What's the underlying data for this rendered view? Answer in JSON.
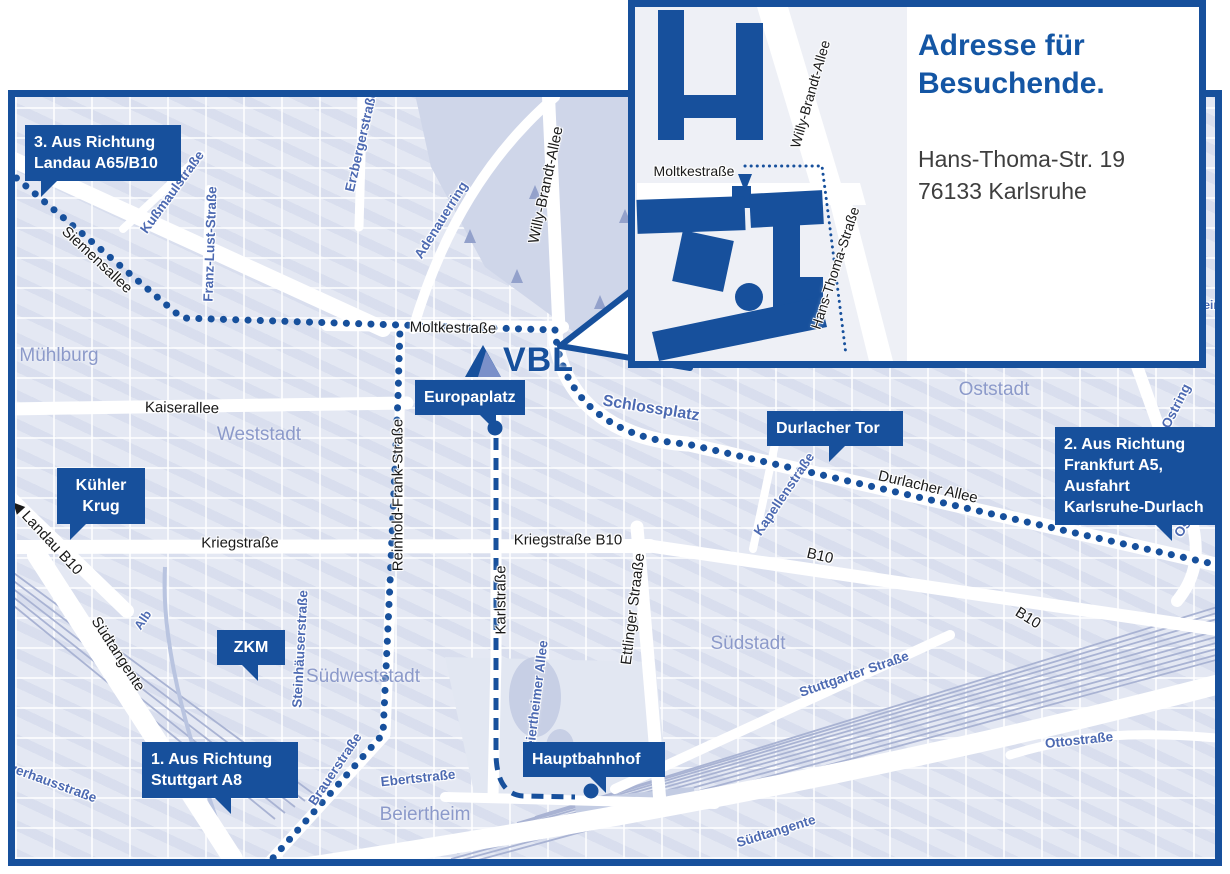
{
  "colors": {
    "brand_blue": "#17509c",
    "title_blue": "#1456a4",
    "map_background": "#e4e8f3",
    "street_label_black": "#1a1a1a",
    "street_label_blue": "#4d6ab2",
    "district_label": "#8c9aca",
    "address_text": "#3e3e3e",
    "park": "#cfd6e9",
    "railway_line": "#a9b3d3"
  },
  "vbl_logo": {
    "text": "VBL"
  },
  "inset": {
    "title_lines": [
      "Adresse für",
      "Besuchende."
    ],
    "address_lines": [
      "Hans-Thoma-Str. 19",
      "76133 Karlsruhe"
    ],
    "labels": [
      {
        "text": "Moltkestraße",
        "x": 59,
        "y": 164,
        "rot": 0,
        "size": 14,
        "color": "black"
      },
      {
        "text": "Willy-Brandt-Allee",
        "x": 175,
        "y": 87,
        "rot": -74,
        "size": 14,
        "color": "black"
      },
      {
        "text": "Hans-Thoma-Straße",
        "x": 200,
        "y": 261,
        "rot": -72,
        "size": 14,
        "color": "black"
      }
    ]
  },
  "map": {
    "callouts": [
      {
        "name": "callout-landau",
        "lines": [
          "3. Aus Richtung",
          "Landau A65/B10"
        ],
        "x": 10,
        "y": 28,
        "w": 138,
        "align": "left",
        "ptr": 16,
        "flip": false,
        "dot": null
      },
      {
        "name": "callout-kuehler-krug",
        "lines": [
          "Kühler",
          "Krug"
        ],
        "x": 42,
        "y": 371,
        "w": 70,
        "align": "center",
        "ptr": 13,
        "flip": false,
        "dot": null
      },
      {
        "name": "callout-zkm",
        "lines": [
          "ZKM"
        ],
        "x": 202,
        "y": 533,
        "w": 50,
        "align": "center",
        "ptr": 24,
        "flip": true,
        "dot": null
      },
      {
        "name": "callout-stuttgart",
        "lines": [
          "1. Aus Richtung",
          "Stuttgart A8"
        ],
        "x": 127,
        "y": 645,
        "w": 138,
        "align": "left",
        "ptr": 72,
        "flip": true,
        "dot": null
      },
      {
        "name": "callout-europaplatz",
        "lines": [
          "Europaplatz"
        ],
        "x": 400,
        "y": 283,
        "w": 92,
        "align": "left",
        "ptr": 64,
        "flip": true,
        "dot": {
          "x": 480,
          "y": 331
        }
      },
      {
        "name": "callout-durlacher-tor",
        "lines": [
          "Durlacher Tor"
        ],
        "x": 752,
        "y": 314,
        "w": 118,
        "align": "left",
        "ptr": 62,
        "flip": false,
        "dot": null
      },
      {
        "name": "callout-frankfurt",
        "lines": [
          "2. Aus Richtung",
          "Frankfurt A5,",
          "Ausfahrt",
          "Karlsruhe-Durlach"
        ],
        "x": 1040,
        "y": 330,
        "w": 152,
        "align": "left",
        "ptr": 100,
        "flip": true,
        "dot": null
      },
      {
        "name": "callout-hauptbahnhof",
        "lines": [
          "Hauptbahnhof"
        ],
        "x": 508,
        "y": 645,
        "w": 124,
        "align": "left",
        "ptr": 66,
        "flip": true,
        "dot": {
          "x": 576,
          "y": 694
        }
      }
    ],
    "streets": [
      {
        "text": "Siemensallee",
        "x": 82,
        "y": 163,
        "rot": 43,
        "color": "black"
      },
      {
        "text": "Moltkestraße",
        "x": 438,
        "y": 231,
        "rot": 1,
        "color": "black"
      },
      {
        "text": "Kaiserallee",
        "x": 167,
        "y": 311,
        "rot": 1,
        "color": "black"
      },
      {
        "text": "Kriegstraße",
        "x": 225,
        "y": 446,
        "rot": 0,
        "color": "black"
      },
      {
        "text": "Kriegstraße B10",
        "x": 553,
        "y": 443,
        "rot": 0,
        "color": "black"
      },
      {
        "text": "Durlacher Allee",
        "x": 913,
        "y": 390,
        "rot": 13,
        "color": "black"
      },
      {
        "text": "B10",
        "x": 805,
        "y": 459,
        "rot": 13,
        "color": "black"
      },
      {
        "text": "B10",
        "x": 1013,
        "y": 521,
        "rot": 32,
        "color": "black"
      },
      {
        "text": "Karlstraße",
        "x": 486,
        "y": 503,
        "rot": -90,
        "color": "black"
      },
      {
        "text": "Ettlinger Straaße",
        "x": 618,
        "y": 512,
        "rot": -83,
        "color": "black"
      },
      {
        "text": "Willy-Brandt-Allee",
        "x": 531,
        "y": 88,
        "rot": -78,
        "color": "black"
      },
      {
        "text": "Reinhold-Frank-Straße",
        "x": 383,
        "y": 398,
        "rot": -90,
        "color": "black"
      },
      {
        "text": "◀ Landau B10",
        "x": 32,
        "y": 440,
        "rot": 47,
        "color": "black"
      },
      {
        "text": "Südtangente",
        "x": 103,
        "y": 557,
        "rot": 57,
        "color": "black"
      },
      {
        "text": "Kußmaulstraße",
        "x": 157,
        "y": 95,
        "rot": -54,
        "color": "blue"
      },
      {
        "text": "Franz-Lust-Straße",
        "x": 195,
        "y": 147,
        "rot": -88,
        "color": "blue"
      },
      {
        "text": "Erzbergerstraße",
        "x": 346,
        "y": 44,
        "rot": -77,
        "color": "blue"
      },
      {
        "text": "Adenauerring",
        "x": 426,
        "y": 123,
        "rot": -58,
        "color": "blue"
      },
      {
        "text": "Schlossplatz",
        "x": 636,
        "y": 312,
        "rot": 9,
        "color": "blue",
        "size": 16
      },
      {
        "text": "Kapellenstraße",
        "x": 769,
        "y": 397,
        "rot": -56,
        "color": "blue"
      },
      {
        "text": "Ostring",
        "x": 1161,
        "y": 309,
        "rot": -63,
        "color": "blue"
      },
      {
        "text": "Ostring",
        "x": 1176,
        "y": 419,
        "rot": -55,
        "color": "blue"
      },
      {
        "text": "Steinhäuserstraße",
        "x": 285,
        "y": 552,
        "rot": -87,
        "color": "blue"
      },
      {
        "text": "Brauerstraße",
        "x": 320,
        "y": 672,
        "rot": -56,
        "color": "blue"
      },
      {
        "text": "Ebertstraße",
        "x": 403,
        "y": 681,
        "rot": -6,
        "color": "blue"
      },
      {
        "text": "Beiertheimer Allee",
        "x": 521,
        "y": 602,
        "rot": -83,
        "color": "blue"
      },
      {
        "text": "Stuttgarter Straße",
        "x": 839,
        "y": 577,
        "rot": -19,
        "color": "blue"
      },
      {
        "text": "Ottostraße",
        "x": 1064,
        "y": 643,
        "rot": -6,
        "color": "blue"
      },
      {
        "text": "Südtangente",
        "x": 761,
        "y": 734,
        "rot": -17,
        "color": "blue"
      },
      {
        "text": "Alb",
        "x": 128,
        "y": 523,
        "rot": -56,
        "color": "blue",
        "size": 12.5
      },
      {
        "text": "Pulverhausstraße",
        "x": 28,
        "y": 682,
        "rot": 20,
        "color": "blue"
      },
      {
        "text": "we",
        "x": 1150,
        "y": 163,
        "rot": -62,
        "color": "blue",
        "size": 12
      },
      {
        "text": "ein",
        "x": 1197,
        "y": 208,
        "rot": 0,
        "color": "blue",
        "size": 12
      }
    ],
    "districts": [
      {
        "text": "Mühlburg",
        "x": 44,
        "y": 259
      },
      {
        "text": "Weststadt",
        "x": 244,
        "y": 338
      },
      {
        "text": "Südweststadt",
        "x": 348,
        "y": 580
      },
      {
        "text": "Südstadt",
        "x": 733,
        "y": 547
      },
      {
        "text": "Oststadt",
        "x": 979,
        "y": 293
      },
      {
        "text": "Beiertheim",
        "x": 410,
        "y": 718
      }
    ]
  }
}
